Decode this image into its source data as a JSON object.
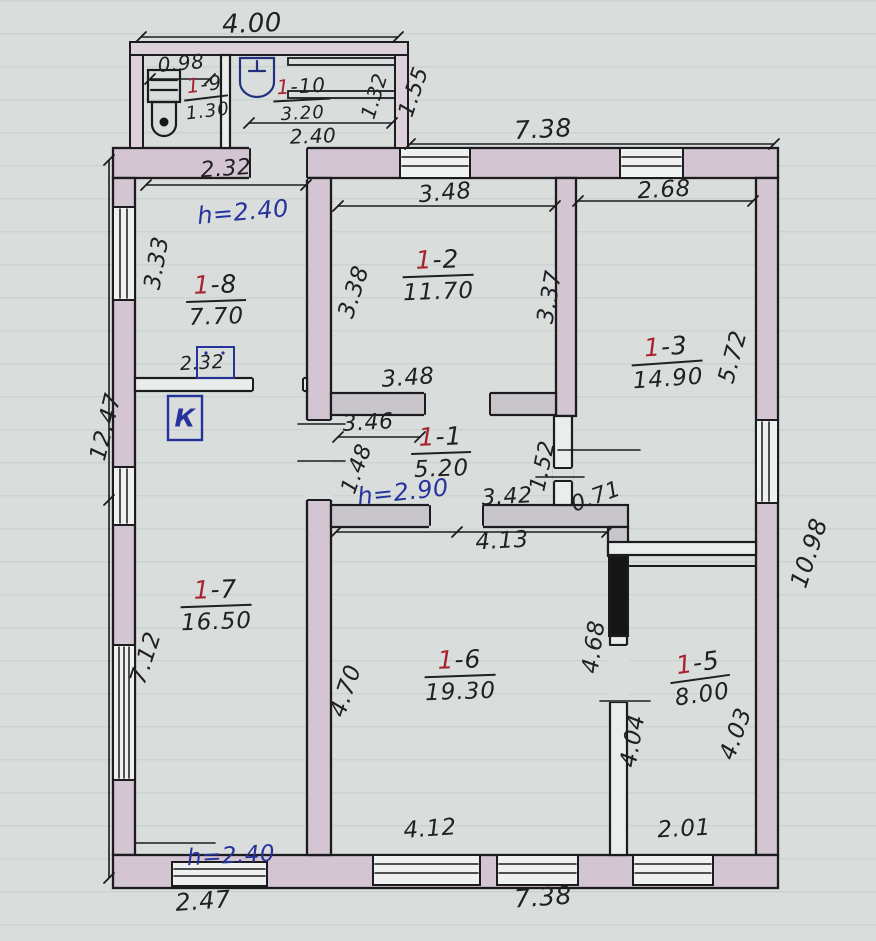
{
  "document": {
    "kind": "hand-drawn apartment floor plan sketch",
    "units": "meters"
  },
  "colors": {
    "paper": "#d9dedd",
    "wall_fill": "#d3c6d2",
    "pencil_wall_fill": "#c8c5cb",
    "ink": "#201f21",
    "room_number_red": "#a8232f",
    "note_blue": "#27339c"
  },
  "rooms": {
    "r1": {
      "num_red": "1",
      "num_rest": "-1",
      "area": "5.20"
    },
    "r2": {
      "num_red": "1",
      "num_rest": "-2",
      "area": "11.70"
    },
    "r3": {
      "num_red": "1",
      "num_rest": "-3",
      "area": "14.90"
    },
    "r5": {
      "num_red": "1",
      "num_rest": "-5",
      "area": "8.00"
    },
    "r6": {
      "num_red": "1",
      "num_rest": "-6",
      "area": "19.30"
    },
    "r7": {
      "num_red": "1",
      "num_rest": "-7",
      "area": "16.50"
    },
    "r8": {
      "num_red": "1",
      "num_rest": "-8",
      "area": "7.70"
    },
    "r9": {
      "num_red": "1",
      "num_rest": "-9",
      "area": "1.30"
    },
    "r10": {
      "num_red": "1",
      "num_rest": "-10",
      "area": "3.20"
    }
  },
  "heights": {
    "room_1_8": "h=2.40",
    "room_1_1": "h=2.90",
    "porch": "h=2.40"
  },
  "dimensions": {
    "annex_width": "4.00",
    "wc_width": "0.98",
    "annex_door": "2.40",
    "annex_diag": "1.32",
    "annex_depth": "1.55",
    "top_main": "7.38",
    "r8_top": "2.32",
    "r8_left": "3.33",
    "r8_bottom": "2.32",
    "r2_top": "3.48",
    "r2_left": "3.38",
    "r2_right": "3.37",
    "r2_bottom": "3.48",
    "r3_top": "2.68",
    "r3_right": "5.72",
    "r1_top": "3.46",
    "r1_left": "1.48",
    "r1_right": "1.52",
    "r1_bottom": "3.42",
    "r1_pocket": "0.71",
    "r6_top": "4.13",
    "left_total": "12.47",
    "left_lower": "7.12",
    "r6_left": "4.70",
    "r6_right": "4.68",
    "r6_bottom": "4.12",
    "r5_left": "4.04",
    "r5_right": "4.03",
    "r5_bottom": "2.01",
    "right_total": "10.98",
    "porch_bottom": "2.47",
    "bottom_main": "7.38"
  },
  "symbols": {
    "boiler": "К"
  }
}
